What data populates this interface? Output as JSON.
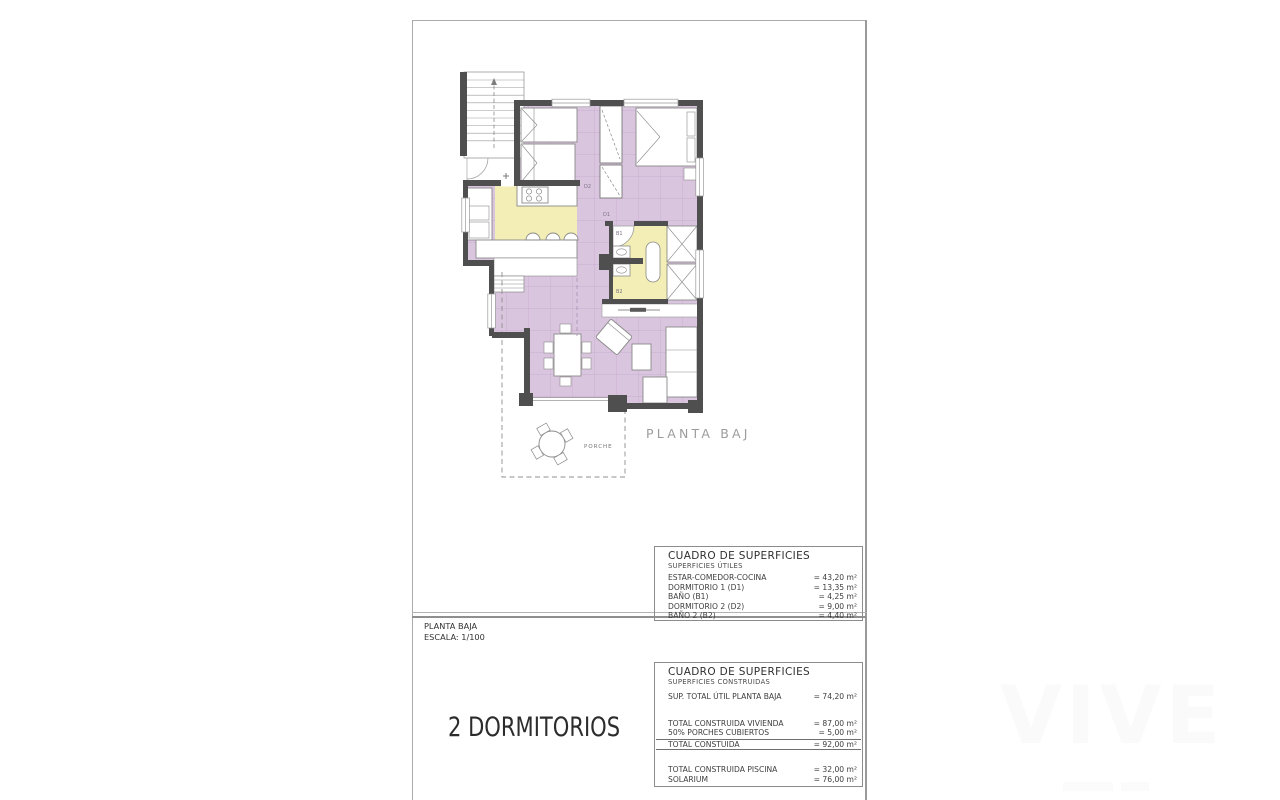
{
  "plan": {
    "caption": "PLANTA BAJA",
    "labels": {
      "d1": "D1",
      "d2": "D2",
      "b1": "B1",
      "b2": "B2",
      "porch": "PORCHE"
    }
  },
  "title_block": {
    "plan_name": "PLANTA BAJA",
    "scale": "ESCALA: 1/100",
    "bedrooms": "2 DORMITORIOS"
  },
  "tables": {
    "utiles": {
      "title": "CUADRO DE SUPERFICIES",
      "subtitle": "SUPERFICIES ÚTILES",
      "rows": [
        {
          "label": "ESTAR-COMEDOR-COCINA",
          "value": "= 43,20 m²"
        },
        {
          "label": "DORMITORIO 1 (D1)",
          "value": "= 13,35 m²"
        },
        {
          "label": "BAÑO  (B1)",
          "value": "= 4,25 m²"
        },
        {
          "label": "DORMITORIO 2 (D2)",
          "value": "= 9,00 m²"
        },
        {
          "label": "BAÑO 2 (B2)",
          "value": "= 4,40 m²"
        }
      ]
    },
    "construidas": {
      "title": "CUADRO DE SUPERFICIES",
      "subtitle": "SUPERFICIES CONSTRUIDAS",
      "sup_total": {
        "label": "SUP. TOTAL ÚTIL PLANTA BAJA",
        "value": "= 74,20 m²"
      },
      "rows2": [
        {
          "label": "TOTAL CONSTRUIDA VIVIENDA",
          "value": "= 87,00 m²"
        },
        {
          "label": "50% PORCHES CUBIERTOS",
          "value": "= 5,00 m²"
        }
      ],
      "total_row": {
        "label": "TOTAL CONSTUIDA",
        "value": "= 92,00 m²"
      },
      "rows3": [
        {
          "label": "TOTAL CONSTRUIDA PISCINA",
          "value": "= 32,00 m²"
        },
        {
          "label": "SOLARIUM",
          "value": "= 76,00 m²"
        }
      ]
    }
  },
  "watermark": "VIVE",
  "colors": {
    "floor_lavender": "#d9c5de",
    "floor_yellow": "#f3eeb5",
    "wall": "#4f4f50",
    "caption_gray": "#9c9c9c"
  }
}
